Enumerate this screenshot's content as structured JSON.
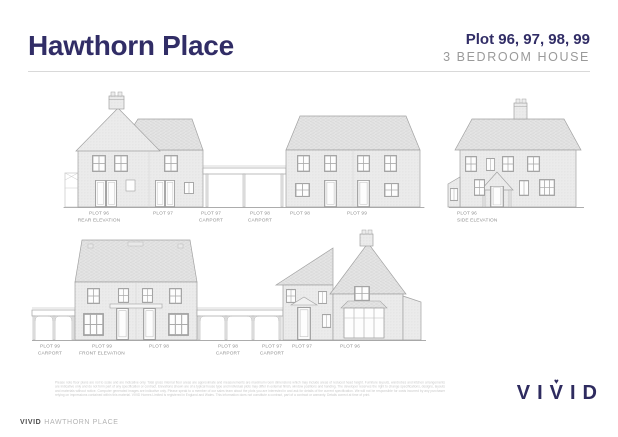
{
  "header": {
    "title": "Hawthorn Place",
    "plots": "Plot 96, 97, 98, 99",
    "subtitle": "3 BEDROOM HOUSE"
  },
  "colors": {
    "brand_navy": "#312d66",
    "subtitle_gray": "#9a9a9a",
    "drawing_line_gray": "#a2a2a2",
    "label_gray": "#8f8f8f"
  },
  "labels": {
    "top": [
      {
        "line1": "PLOT 96",
        "line2": "REAR ELEVATION"
      },
      {
        "line1": "PLOT 97",
        "line2": ""
      },
      {
        "line1": "PLOT 97",
        "line2": "CARPORT"
      },
      {
        "line1": "PLOT 98",
        "line2": "CARPORT"
      },
      {
        "line1": "PLOT 98",
        "line2": ""
      },
      {
        "line1": "PLOT 99",
        "line2": ""
      },
      {
        "line1": "PLOT 96",
        "line2": "SIDE ELEVATION"
      }
    ],
    "bottom": [
      {
        "line1": "PLOT 99",
        "line2": "CARPORT"
      },
      {
        "line1": "PLOT 99",
        "line2": "FRONT ELEVATION"
      },
      {
        "line1": "PLOT 98",
        "line2": ""
      },
      {
        "line1": "PLOT 98",
        "line2": "CARPORT"
      },
      {
        "line1": "PLOT 97",
        "line2": "CARPORT"
      },
      {
        "line1": "PLOT 97",
        "line2": ""
      },
      {
        "line1": "PLOT 96",
        "line2": ""
      }
    ]
  },
  "footer": {
    "disclaimer": "Please note floor plans are not to scale and are indicative only. Total gross internal floor areas are approximate and measurements are maximum room dimensions which may include areas of reduced head height. Furniture layouts, wardrobes and kitchen arrangements are indicative only and do not form part of any specification or contract. Elevations shown are of a typical house type and individual plots may differ in external finish, window positions and handing. The developer reserves the right to change specifications, designs, layouts and materials without notice. Computer generated images are indicative only. Please speak to a member of our sales team about the plots you are interested in and ask for details of the current specification. We will not be responsible for costs incurred by any purchaser relying on impressions contained within this material. VIVID Homes Limited is registered in England and Wales. This information does not constitute a contract, part of a contract or warranty. Details correct at time of print.",
    "brand": "VIVID",
    "project": "HAWTHORN PLACE",
    "logo": {
      "letters": [
        "V",
        "I",
        "V",
        "I",
        "D"
      ],
      "heart": "♥"
    }
  }
}
